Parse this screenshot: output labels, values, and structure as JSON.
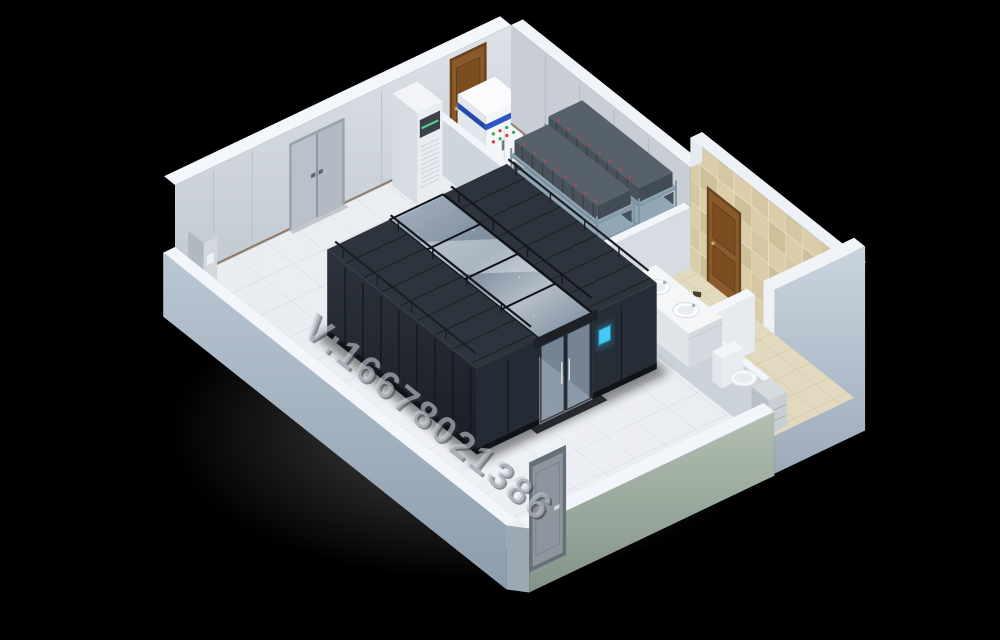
{
  "scene": {
    "subject": "3D isometric cutaway render of a server room floor plan",
    "background_color": "#000000",
    "watermark": {
      "text": "V:16678021386"
    },
    "palette": {
      "floor": "#e9ecf1",
      "wall": "#cfd5dc",
      "wall_top": "#f3f6fa",
      "outer_wall": "#a7b4c0",
      "rack_dark": "#262b33",
      "aisle_glass": "#aebfd0",
      "wood_door": "#8a5a2c",
      "bath_tile": "#d8caa7",
      "screen_accent": "#45c8f2",
      "cabinet_stripe_blue": "#2e55c8",
      "indicator_red": "#d23c30",
      "indicator_green": "#2fae4e"
    },
    "objects": [
      {
        "name": "cold-aisle-containment",
        "label": "server rack rows with glass aisle roof"
      },
      {
        "name": "aisle-end-doors",
        "label": "sliding glass aisle doors"
      },
      {
        "name": "rack-status-screen",
        "label": "rack LCD screen"
      },
      {
        "name": "precision-ac-unit",
        "label": "floor standing air conditioner"
      },
      {
        "name": "power-distribution-cabinet",
        "label": "power cabinet with indicator lights"
      },
      {
        "name": "battery-rack-1",
        "label": "UPS battery rack"
      },
      {
        "name": "battery-rack-2",
        "label": "UPS battery rack"
      },
      {
        "name": "double-door",
        "label": "double service door"
      },
      {
        "name": "vestibule-door",
        "label": "wooden vestibule door"
      },
      {
        "name": "bathroom-door",
        "label": "wooden bathroom door"
      },
      {
        "name": "entrance-door",
        "label": "metal entrance door"
      },
      {
        "name": "bathroom-vanity",
        "label": "vanity with two sinks"
      },
      {
        "name": "toilet",
        "label": "toilet"
      },
      {
        "name": "corner-pillar-cabinet",
        "label": "slim wall cabinet"
      }
    ]
  }
}
